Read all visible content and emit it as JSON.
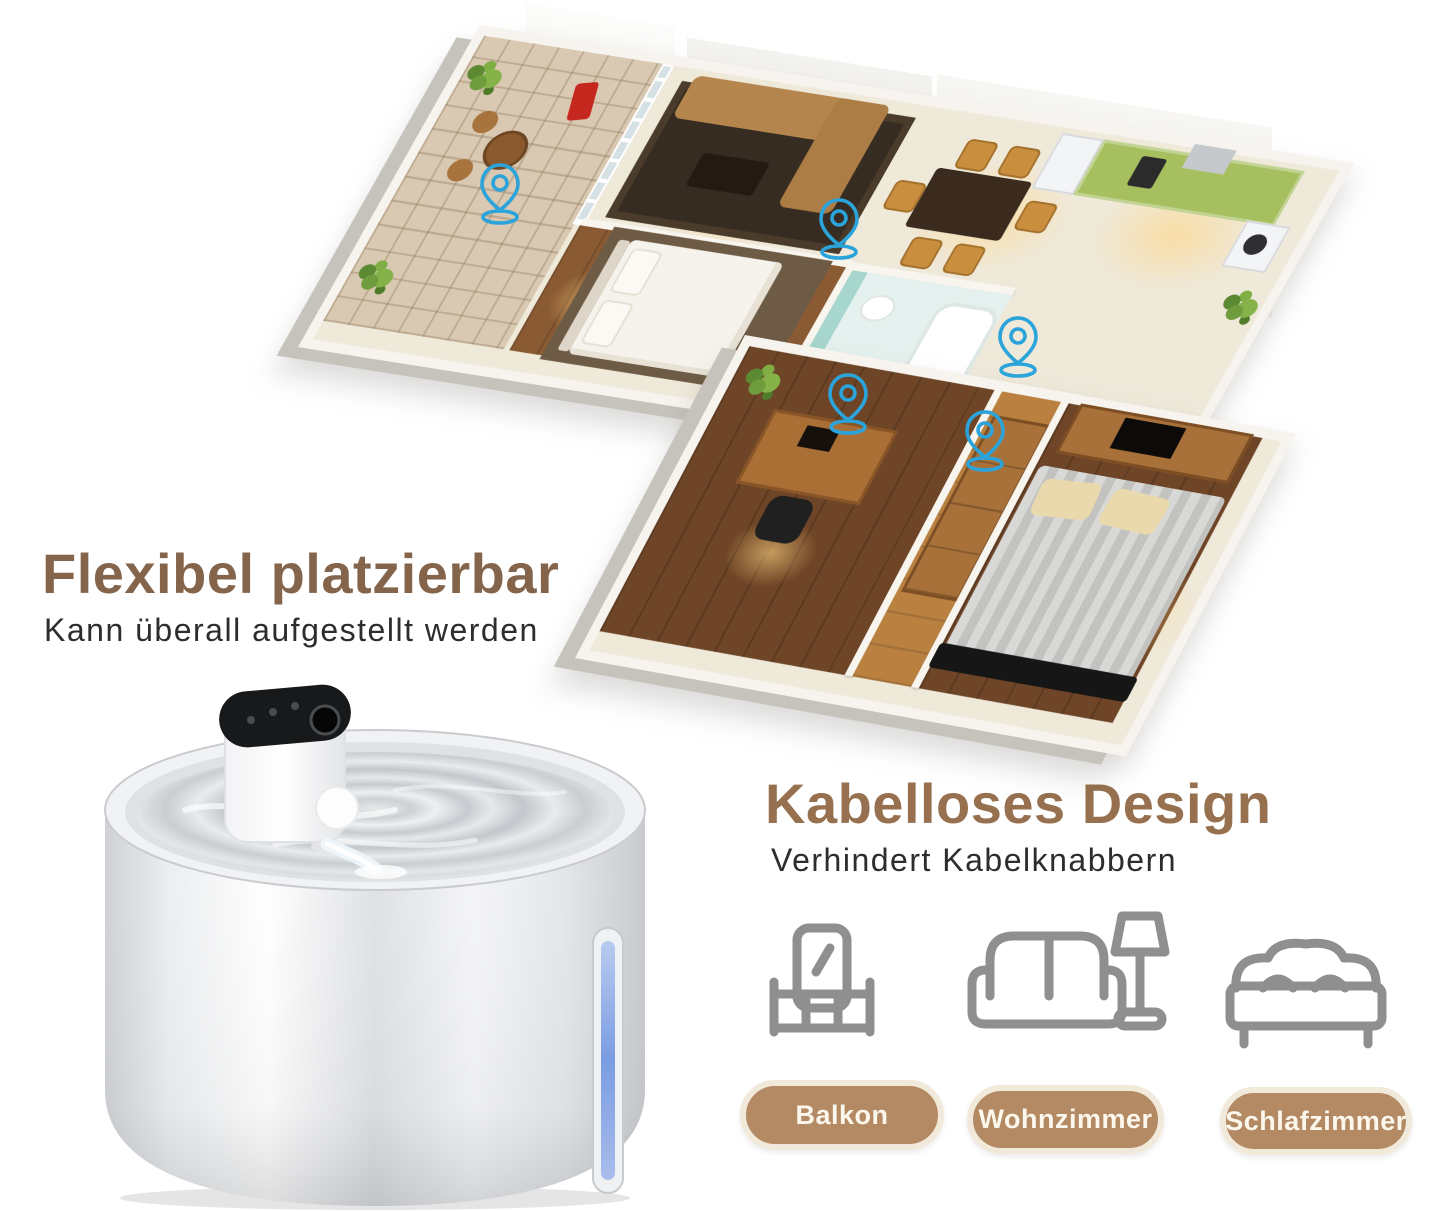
{
  "language": "de",
  "theme": {
    "accent-blue": "#2BA3DB",
    "heading-brown": "#84654B",
    "heading-brown-right": "#97714F",
    "subtitle-dark": "#2D2D2D",
    "badge-fill": "#B38A64",
    "badge-border": "#F1EADB",
    "badge-text": "#FCF7EC",
    "icon-gray": "#8F8F8F"
  },
  "floorplan": {
    "description": "Isometric 3D apartment floor plan with blue location pins marking possible fountain placements",
    "pin_icon": "location-pin-icon",
    "pin_color": "#2BA3DB",
    "pin_count": 5,
    "pins": [
      {
        "room": "balcony",
        "x": 500,
        "y": 215
      },
      {
        "room": "dining-area",
        "x": 837,
        "y": 250
      },
      {
        "room": "hallway",
        "x": 1018,
        "y": 368
      },
      {
        "room": "office",
        "x": 848,
        "y": 425
      },
      {
        "room": "bedroom",
        "x": 985,
        "y": 462
      }
    ]
  },
  "flexible_section": {
    "title": "Flexibel platzierbar",
    "subtitle": "Kann überall aufgestellt werden"
  },
  "wireless_section": {
    "title": "Kabelloses Design",
    "subtitle": "Verhindert Kabelknabbern"
  },
  "product_image": {
    "description": "white cordless pet water fountain with black touch control panel, pouring water stream and blue water level window"
  },
  "room_badges": [
    {
      "id": "balkon",
      "icon": "balcony-icon",
      "label": "Balkon"
    },
    {
      "id": "wohnzimmer",
      "icon": "sofa-lamp-icon",
      "label": "Wohnzimmer"
    },
    {
      "id": "schlafzimmer",
      "icon": "bed-icon",
      "label": "Schlafzimmer"
    }
  ]
}
